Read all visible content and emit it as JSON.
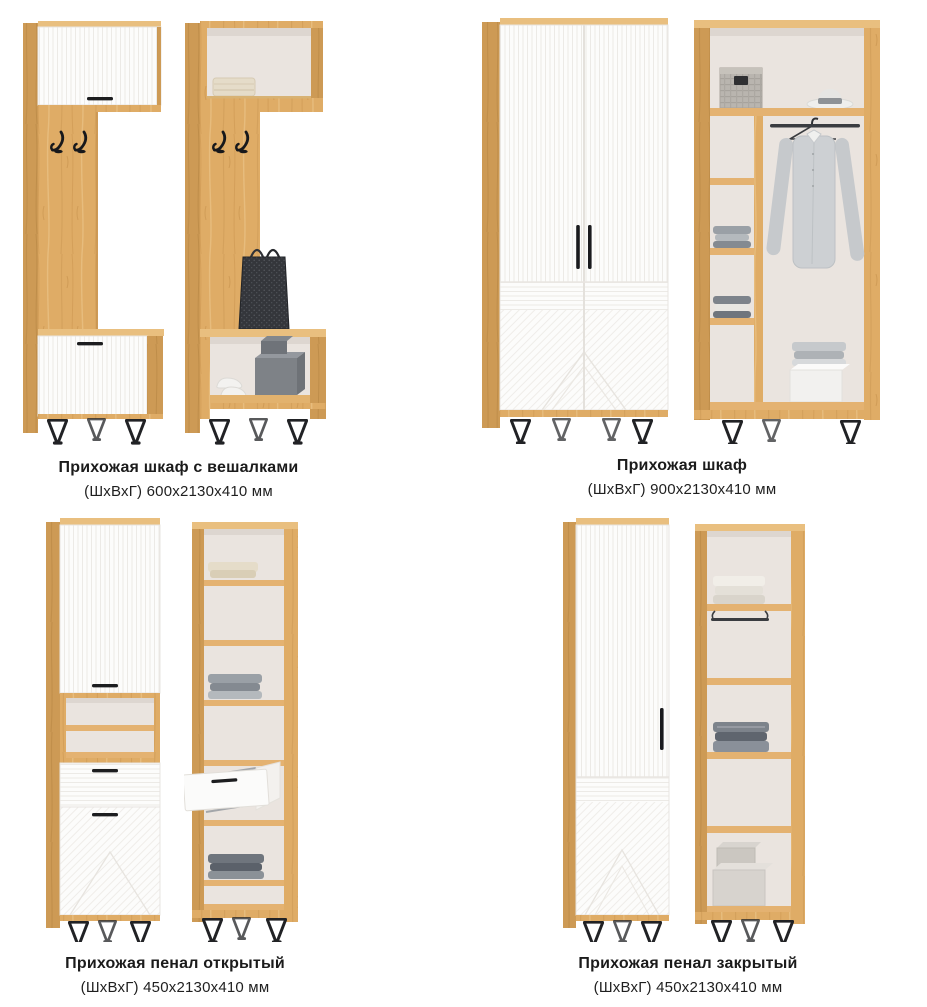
{
  "products": [
    {
      "name": "Прихожая шкаф с вешалками",
      "dimensions": "(ШхВхГ) 600х2130х410 мм"
    },
    {
      "name": "Прихожая шкаф",
      "dimensions": "(ШхВхГ) 900х2130х410 мм"
    },
    {
      "name": "Прихожая пенал открытый",
      "dimensions": "(ШхВхГ) 450х2130х410 мм"
    },
    {
      "name": "Прихожая пенал закрытый",
      "dimensions": "(ШхВхГ) 450х2130х410 мм"
    }
  ],
  "colors": {
    "background": "#FFFFFF",
    "wood": "#DFAC66",
    "wood_dark": "#CD9A55",
    "wood_light": "#E9BF7F",
    "panel_white": "#FCFCFB",
    "interior": "#EAE4DF",
    "accent_black": "#1C1D1F",
    "text": "#1B1B1B"
  }
}
